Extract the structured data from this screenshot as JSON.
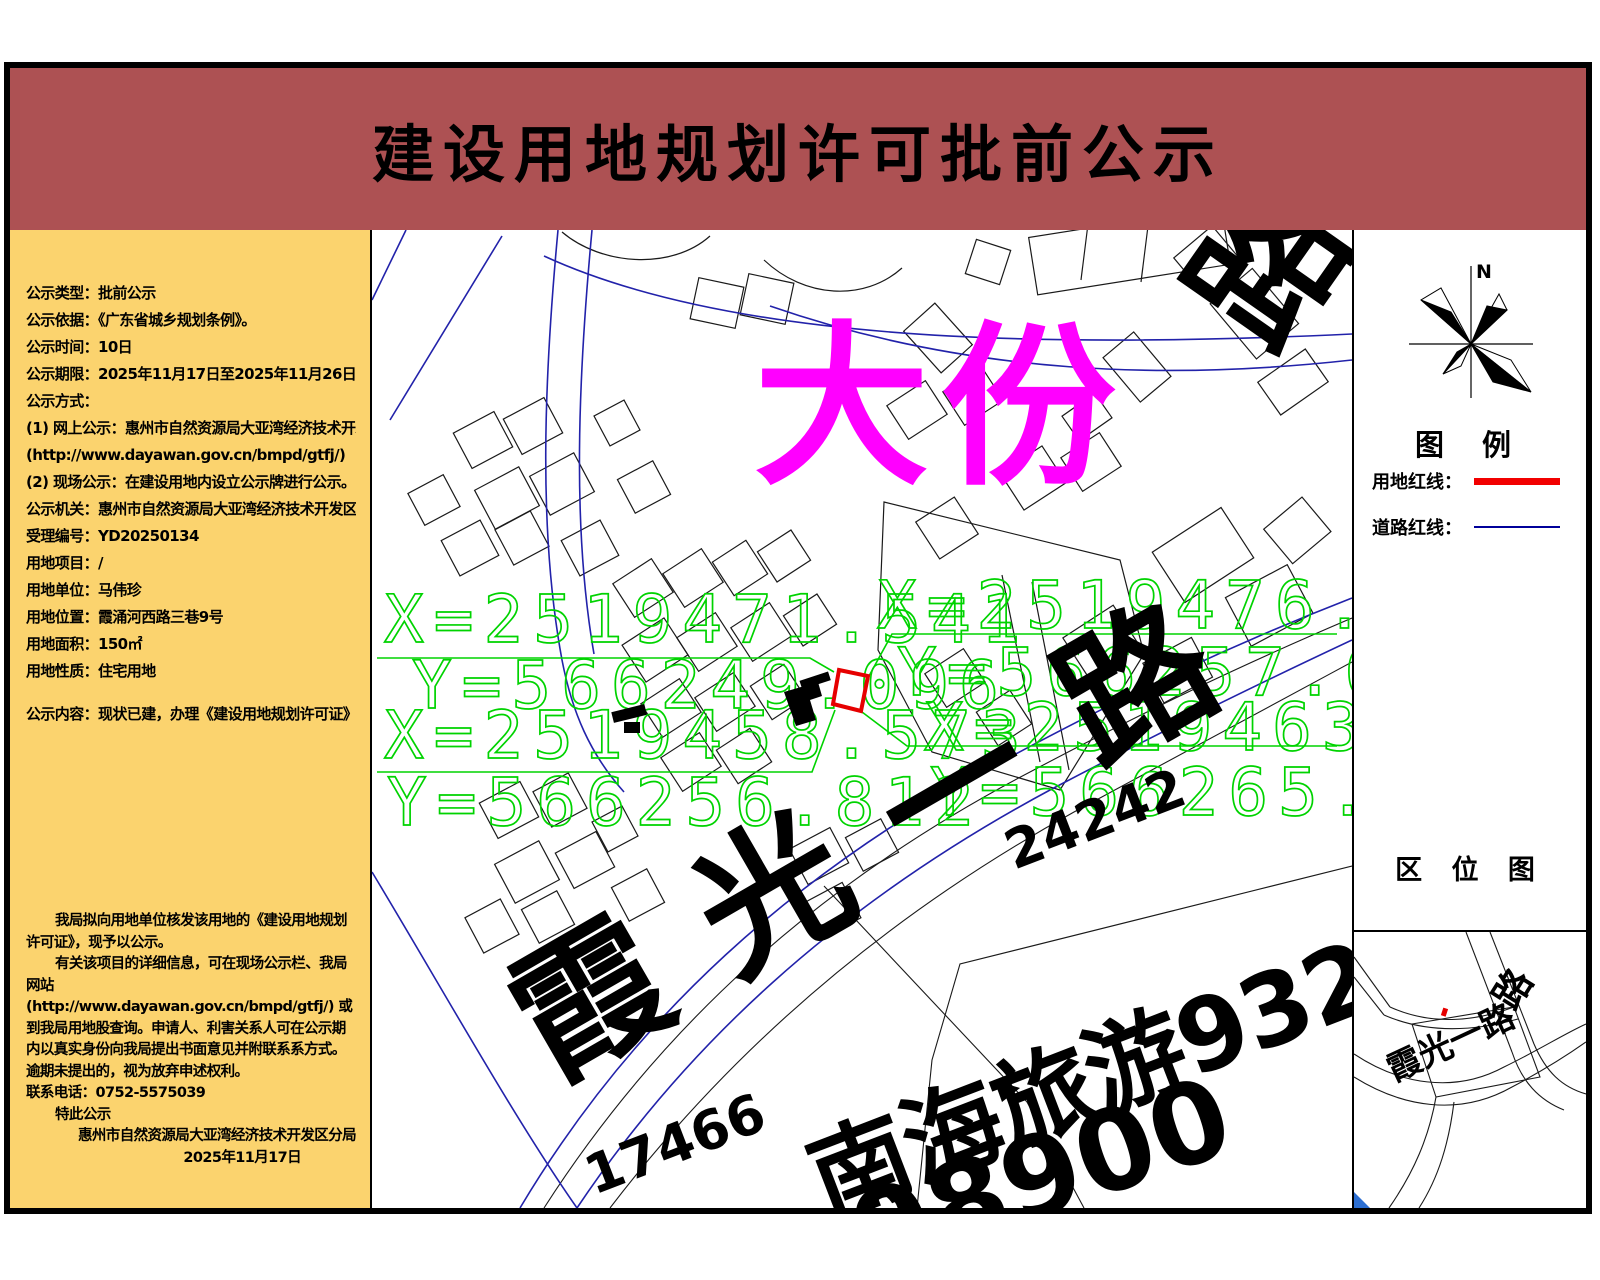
{
  "header": {
    "title": "建设用地规划许可批前公示"
  },
  "sidebar": {
    "lines": [
      "公示类型：批前公示",
      "公示依据：《广东省城乡规划条例》。",
      "公示时间：10日",
      "公示期限：2025年11月17日至2025年11月26日",
      "公示方式：",
      "(1) 网上公示：惠州市自然资源局大亚湾经济技术开发区分局",
      "(http://www.dayawan.gov.cn/bmpd/gtfj/)",
      "(2) 现场公示：在建设用地内设立公示牌进行公示。",
      "公示机关：惠州市自然资源局大亚湾经济技术开发区分局",
      "受理编号：YD20250134",
      "用地项目：/",
      "用地单位：马伟珍",
      "用地位置：霞涌河西路三巷9号",
      "用地面积：150㎡",
      "用地性质：住宅用地",
      "公示内容：现状已建，办理《建设用地规划许可证》手续。"
    ],
    "paragraph1": "我局拟向用地单位核发该用地的《建设用地规划许可证》，现予以公示。",
    "paragraph2": "有关该项目的详细信息，可在现场公示栏、我局网站(http://www.dayawan.gov.cn/bmpd/gtfj/) 或到我局用地股查询。申请人、利害关系人可在公示期内以真实身份向我局提出书面意见并附联系系方式。逾期未提出的，视为放弃申述权利。",
    "phone_line": "联系电话：0752-5575039",
    "closing": "特此公示",
    "agency": "惠州市自然资源局大亚湾经济技术开发区分局",
    "date": "2025年11月17日"
  },
  "map": {
    "district_label": "大份",
    "road_label": "霞光一路",
    "road_label_partial": "路",
    "area_label": "南海旅游93264",
    "plot_numbers": {
      "n1": "17466",
      "n2": "24242",
      "n3": "98900"
    },
    "coordinates": {
      "p1x": "X=2519471.541",
      "p1y": "Y=566249.096",
      "p2x": "X=2519458.573",
      "p2y": "Y=566256.812",
      "p3x": "X=2519476.624",
      "p3y": "Y=566257.638",
      "p4x": "X=2519463.656",
      "p4y": "Y=566265.355"
    }
  },
  "panel": {
    "north_label": "N",
    "legend_title": "图  例",
    "legend_items": [
      {
        "label": "用地红线：",
        "color": "#f20000"
      },
      {
        "label": "道路红线：",
        "color": "#00009a"
      }
    ],
    "location_map_title": "区 位 图",
    "location_road_label": "霞光一路",
    "location_road_label_partial": "路"
  },
  "colors": {
    "header_bg": "#ad5153",
    "sidebar_bg": "#fbd36e",
    "parcel_red": "#e60000",
    "road_blue": "#2222aa",
    "coord_green": "#00d300",
    "district_magenta": "#ff00ff"
  }
}
